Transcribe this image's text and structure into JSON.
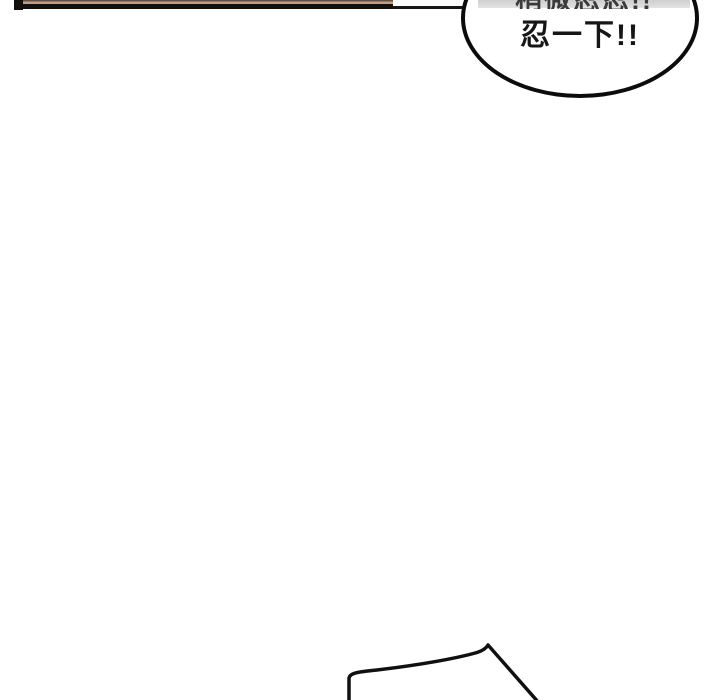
{
  "page": {
    "width": 720,
    "height": 700,
    "background": "#ffffff"
  },
  "top_panel_edge": {
    "bar_color": "#14100e",
    "stripe_color": "#c49e80",
    "thin_line_color": "#171717"
  },
  "speech_bubble": {
    "clipped_line_partially_visible": "稍微忍忍!!",
    "line": "忍一下!!",
    "outline_color": "#0c0c0c",
    "fill_color": "#ffffff",
    "top_shade_color": "#d7d7d7",
    "text_color": "#161616"
  },
  "bottom_artwork": {
    "stroke_color": "#101010"
  }
}
